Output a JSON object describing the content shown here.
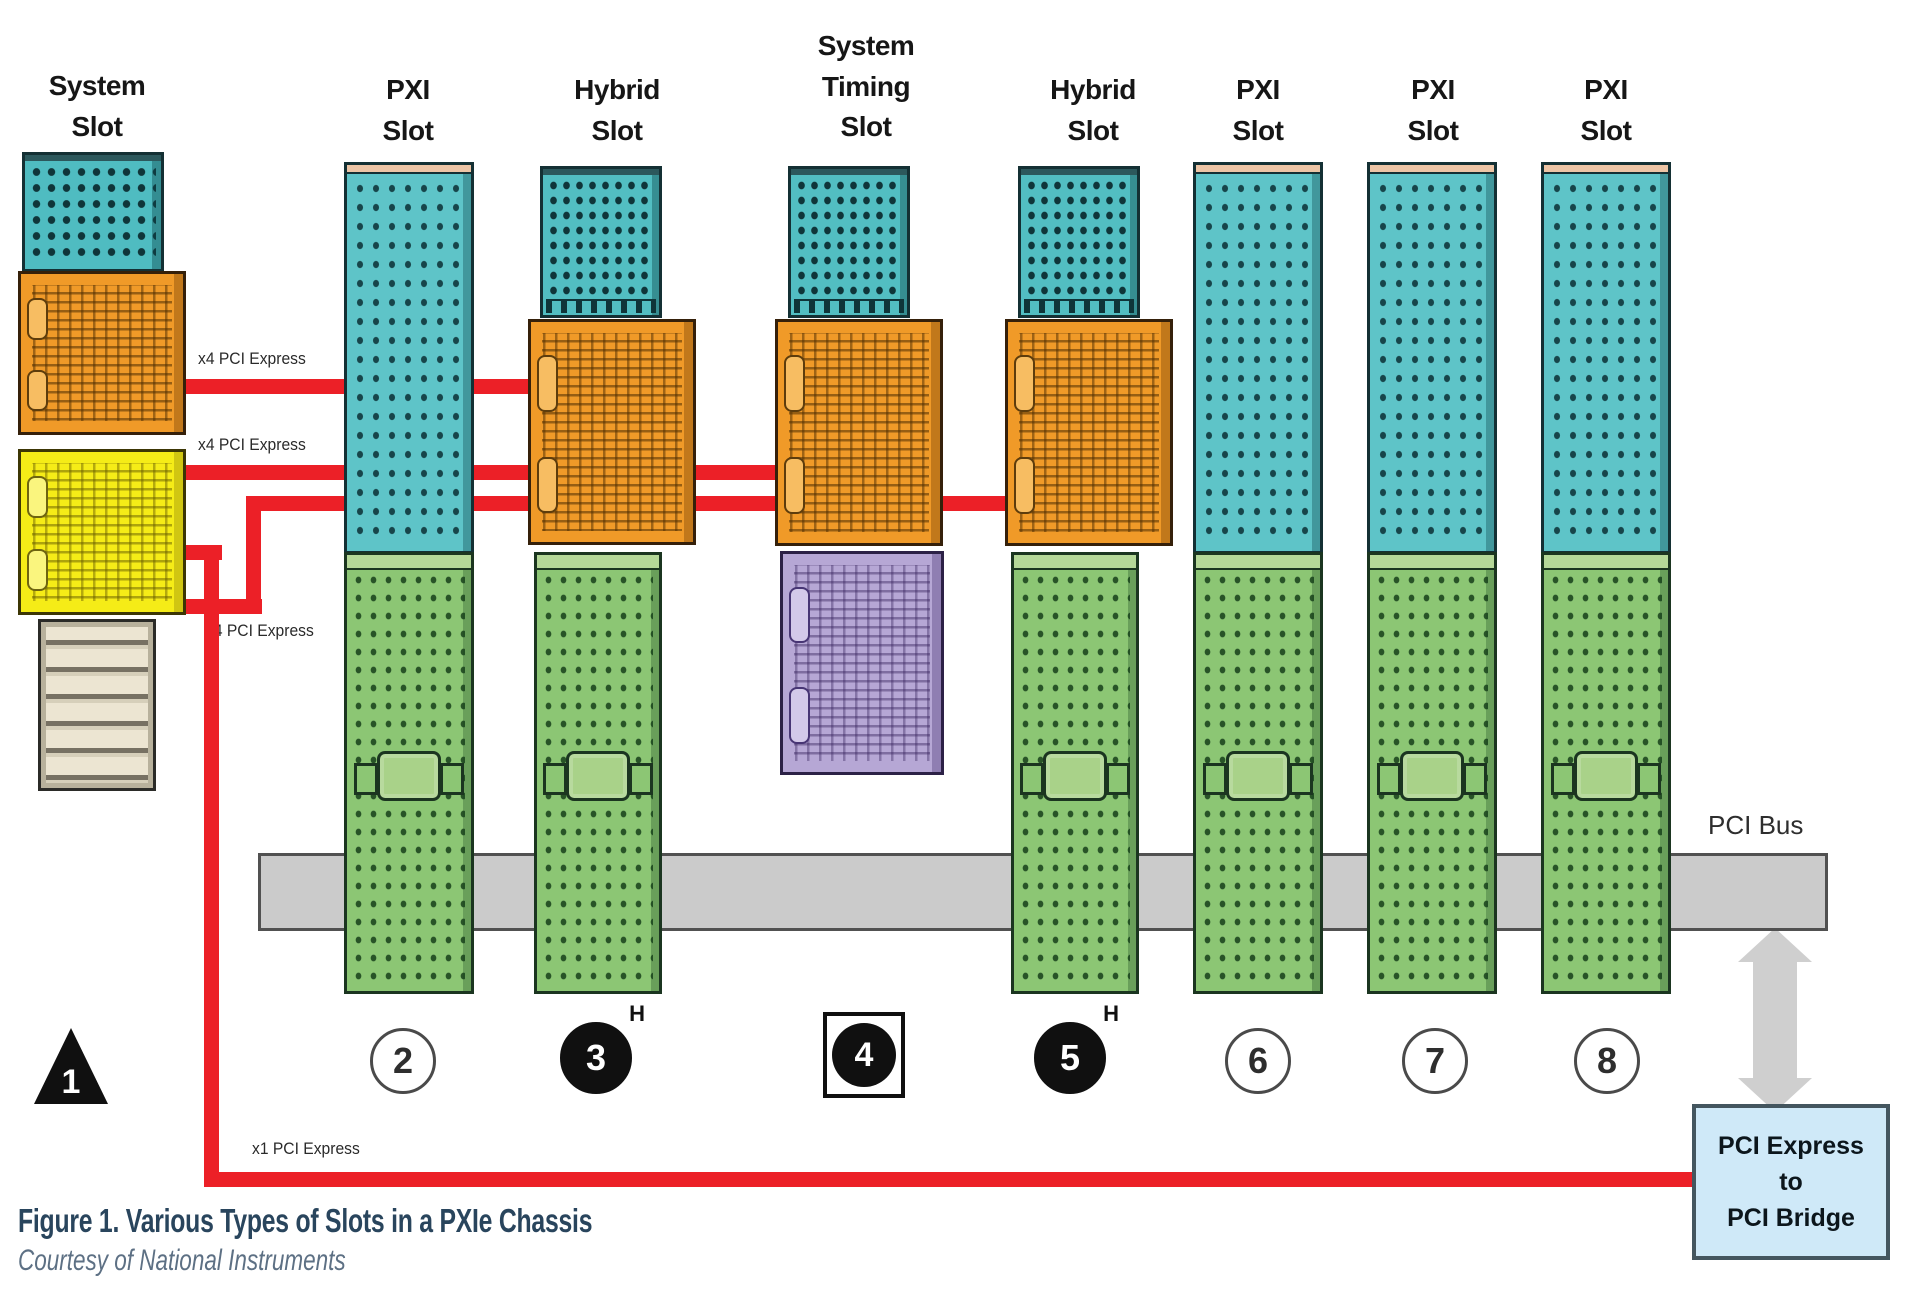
{
  "caption": {
    "title": "Figure 1. Various Types of Slots in a PXIe Chassis",
    "credit": "Courtesy of National Instruments"
  },
  "slots": [
    {
      "label": "System\nSlot",
      "number": "1",
      "marker": ""
    },
    {
      "label": "PXI\nSlot",
      "number": "2",
      "marker": ""
    },
    {
      "label": "Hybrid\nSlot",
      "number": "3",
      "marker": "H"
    },
    {
      "label": "System\nTiming\nSlot",
      "number": "4",
      "marker": ""
    },
    {
      "label": "Hybrid\nSlot",
      "number": "5",
      "marker": "H"
    },
    {
      "label": "PXI\nSlot",
      "number": "6",
      "marker": ""
    },
    {
      "label": "PXI\nSlot",
      "number": "7",
      "marker": ""
    },
    {
      "label": "PXI\nSlot",
      "number": "8",
      "marker": ""
    }
  ],
  "links": [
    {
      "label": "x4 PCI Express"
    },
    {
      "label": "x4 PCI Express"
    },
    {
      "label": "x4 PCI Express"
    },
    {
      "label": "x1 PCI Express"
    }
  ],
  "pci_bus": {
    "label": "PCI Bus"
  },
  "bridge": {
    "label": "PCI Express\nto\nPCI Bridge"
  },
  "colors": {
    "link_red": "#ec2027",
    "pxie_teal": "#5ec4c8",
    "system_teal": "#4fbcc1",
    "pxie_orange": "#f09a28",
    "system_yellow": "#f5ec17",
    "timing_purple": "#b6a7d5",
    "pci_green": "#8cc674",
    "bus_gray": "#cbcbcb",
    "bridge_blue": "#cfe9f8",
    "caption_blue": "#29455d"
  }
}
